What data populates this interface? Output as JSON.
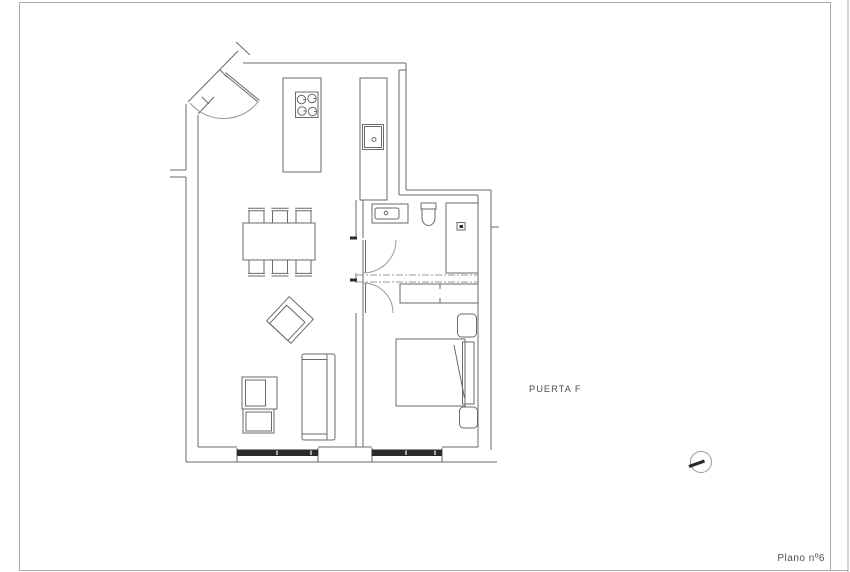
{
  "sheet": {
    "labels": {
      "door": "PUERTA F",
      "plan_number": "Plano nº6"
    },
    "icons": {
      "orientation_marker": "circle-with-needle"
    },
    "colors": {
      "background": "#ffffff",
      "frame": "#ababab",
      "wall": "#6a6a6a",
      "light": "#9a9a9a",
      "dark": "#2b2b2b",
      "text": "#4f4f4f"
    }
  }
}
